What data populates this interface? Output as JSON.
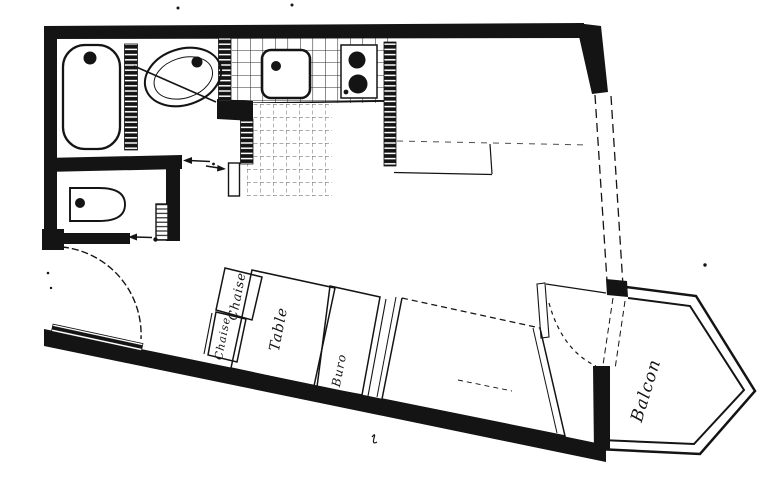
{
  "drawing": {
    "kind": "apartment floor plan (scanned hand drawing)",
    "colors": {
      "ink": "#141414",
      "paper": "#ffffff"
    },
    "labels": {
      "chair_top": "Chaise",
      "chair_bottom": "Chaise",
      "table": "Table",
      "desk": "Buro",
      "balcony": "Balcon"
    },
    "fixtures": [
      "bathtub",
      "washbasin",
      "toilet",
      "radiator",
      "kitchen-sink",
      "stove-two-burners",
      "tiled-counter",
      "tiled-floor",
      "wardrobe",
      "entry-door-swing",
      "balcony-door-swing",
      "bed",
      "table",
      "chair",
      "chair",
      "desk",
      "balcony"
    ]
  }
}
